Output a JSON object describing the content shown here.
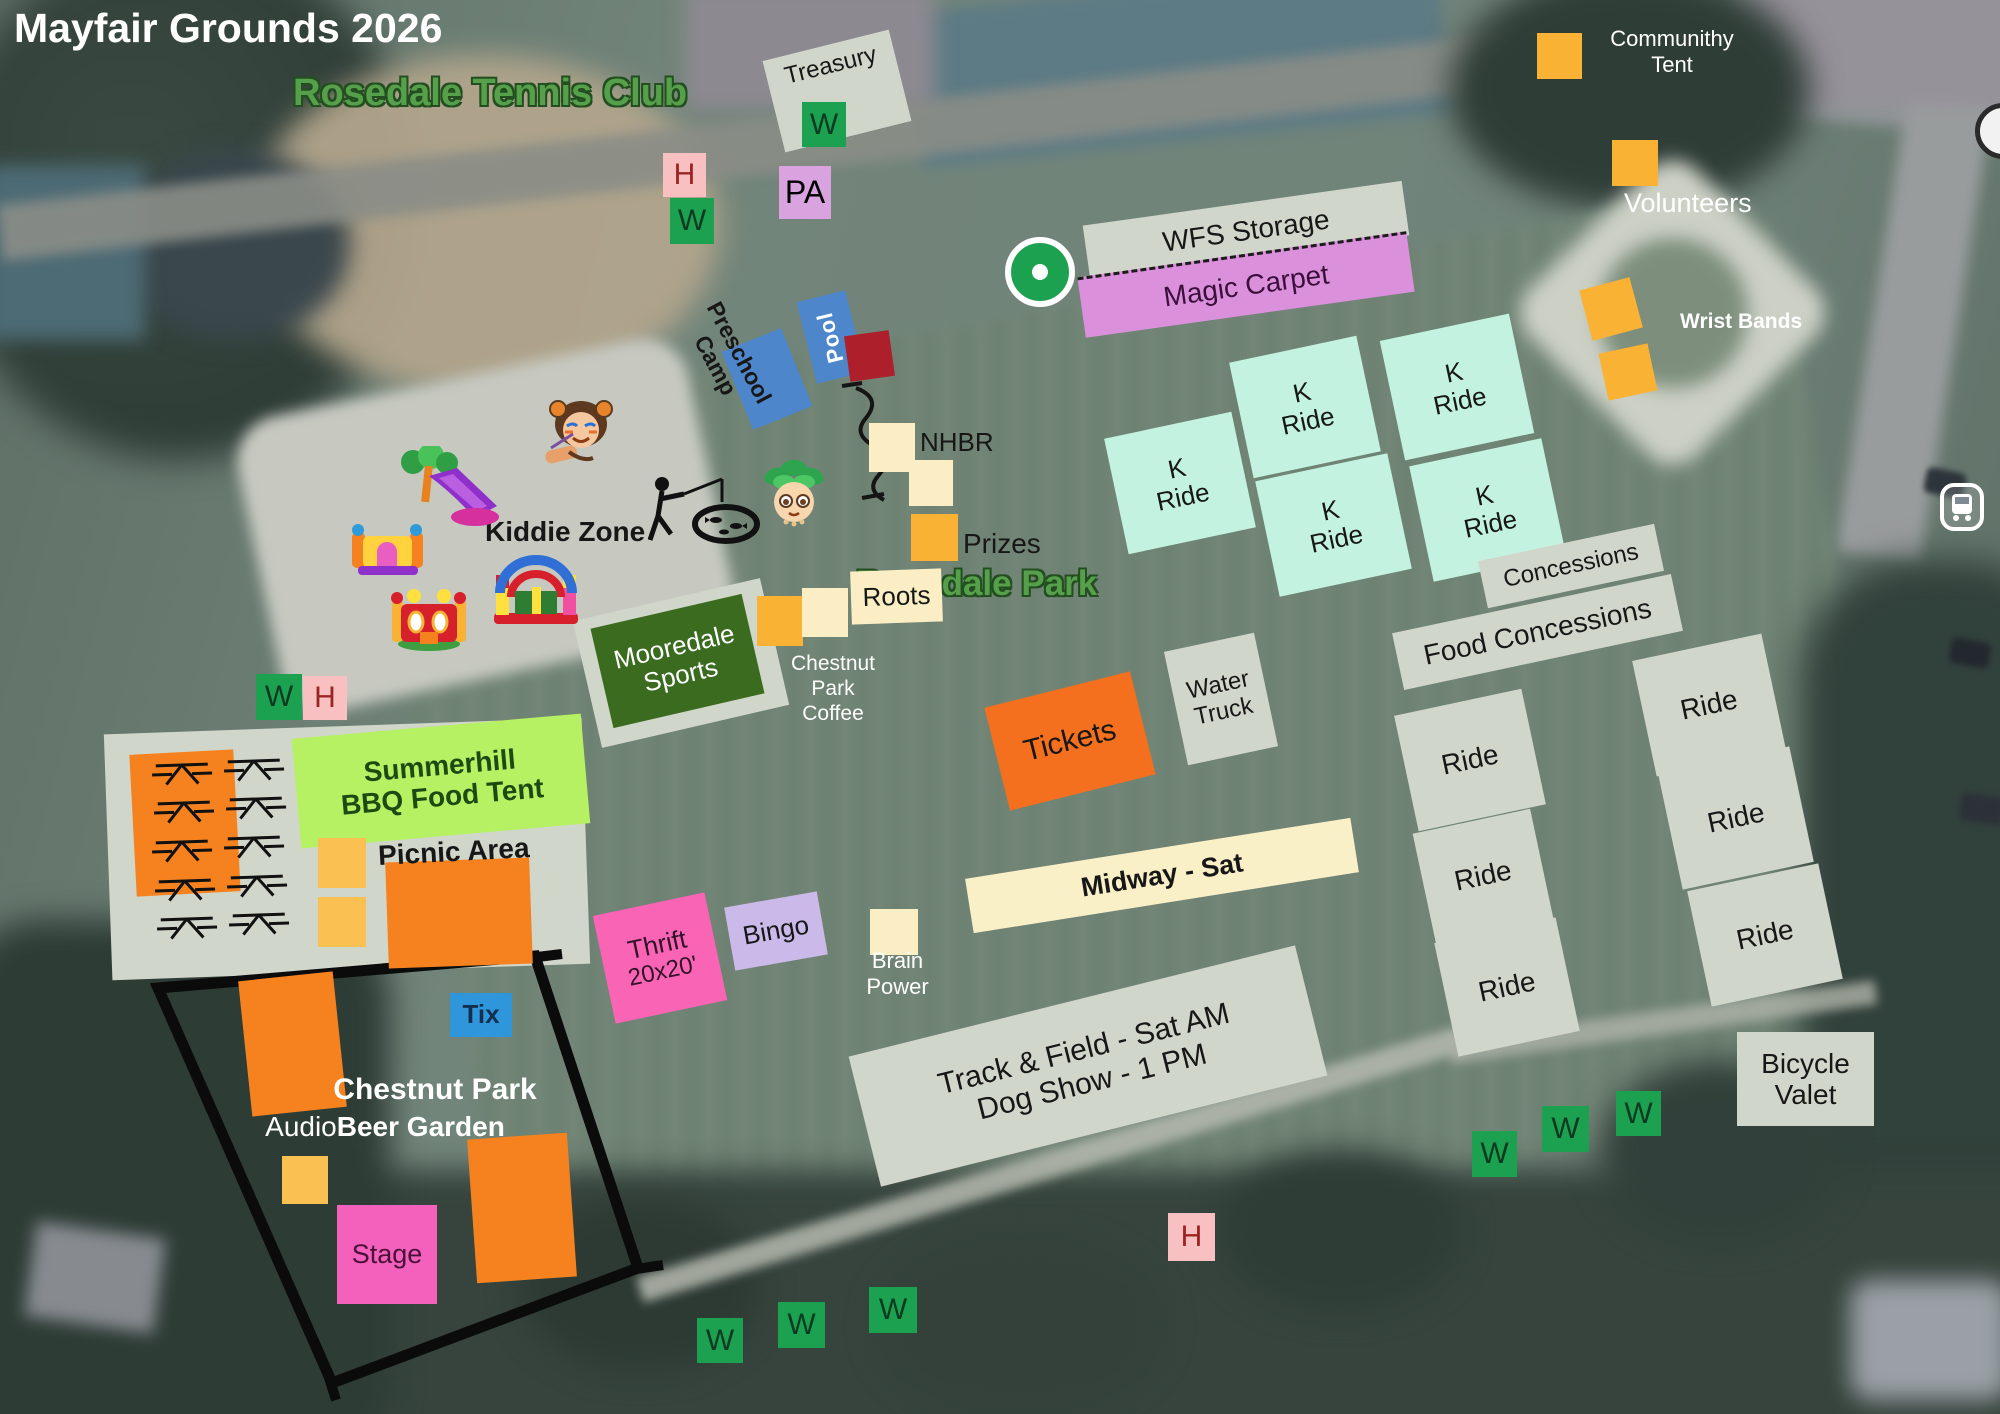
{
  "title": "Mayfair Grounds 2026",
  "map_labels": {
    "tennis_club": "Rosedale Tennis Club",
    "park": "Rosedale Park"
  },
  "markers": {
    "w": "W",
    "h": "H",
    "pa": "PA"
  },
  "zones": {
    "treasury": "Treasury",
    "wfs_storage": "WFS Storage",
    "magic_carpet": "Magic Carpet",
    "community_tent": {
      "line1": "Communithy",
      "line2": "Tent"
    },
    "volunteers": "Volunteers",
    "wrist_bands": "Wrist Bands",
    "k_ride": {
      "line1": "K",
      "line2": "Ride"
    },
    "ride": "Ride",
    "concessions": "Concessions",
    "food_concessions": "Food Concessions",
    "preschool_camp": {
      "line1": "Preschool",
      "line2": "Camp"
    },
    "pool": "Pool",
    "nhbr": "NHBR",
    "prizes": "Prizes",
    "roots": "Roots",
    "chestnut_park_coffee": {
      "line1": "Chestnut",
      "line2": "Park",
      "line3": "Coffee"
    },
    "mooredale_sports": {
      "line1": "Mooredale",
      "line2": "Sports"
    },
    "kiddie_zone": "Kiddie Zone",
    "summerhill": {
      "line1": "Summerhill",
      "line2": "BBQ Food Tent"
    },
    "picnic_area": "Picnic Area",
    "water_truck": {
      "line1": "Water",
      "line2": "Truck"
    },
    "tickets": "Tickets",
    "midway": "Midway - Sat",
    "thrift": {
      "line1": "Thrift",
      "line2": "20x20'"
    },
    "bingo": "Bingo",
    "brain_power": {
      "line1": "Brain",
      "line2": "Power"
    },
    "track_field": {
      "line1": "Track & Field - Sat AM",
      "line2": "Dog Show - 1 PM"
    },
    "beer_garden": {
      "title": "Chestnut Park",
      "audio": "Audio",
      "name": "Beer Garden"
    },
    "tix": "Tix",
    "stage": "Stage",
    "bicycle_valet": {
      "line1": "Bicycle",
      "line2": "Valet"
    }
  },
  "colors": {
    "orange": "#F5821F",
    "amber": "#F9B234",
    "amber_light": "#FBC052",
    "gray": "#D1D6CB",
    "mint": "#C3F3E0",
    "cream": "#FBEEC5",
    "plum": "#D9A3E0",
    "magic": "#DB90DC",
    "blue": "#4E86CC",
    "tix_blue": "#2F96DC",
    "dark_red": "#AE1F2C",
    "hot_pink": "#F964B5",
    "stage_pink": "#F361BD",
    "lavender": "#CAB9E9",
    "tickets_orange": "#F4701E",
    "summer_green": "#B5F162",
    "moore_green": "#3A6B1F",
    "midway_cream": "#FAF0C8",
    "marker_green": "#1CA151",
    "marker_pink": "#F8C0C0",
    "map_text_green": "#57A04B",
    "title_white": "#FFFFFF"
  }
}
